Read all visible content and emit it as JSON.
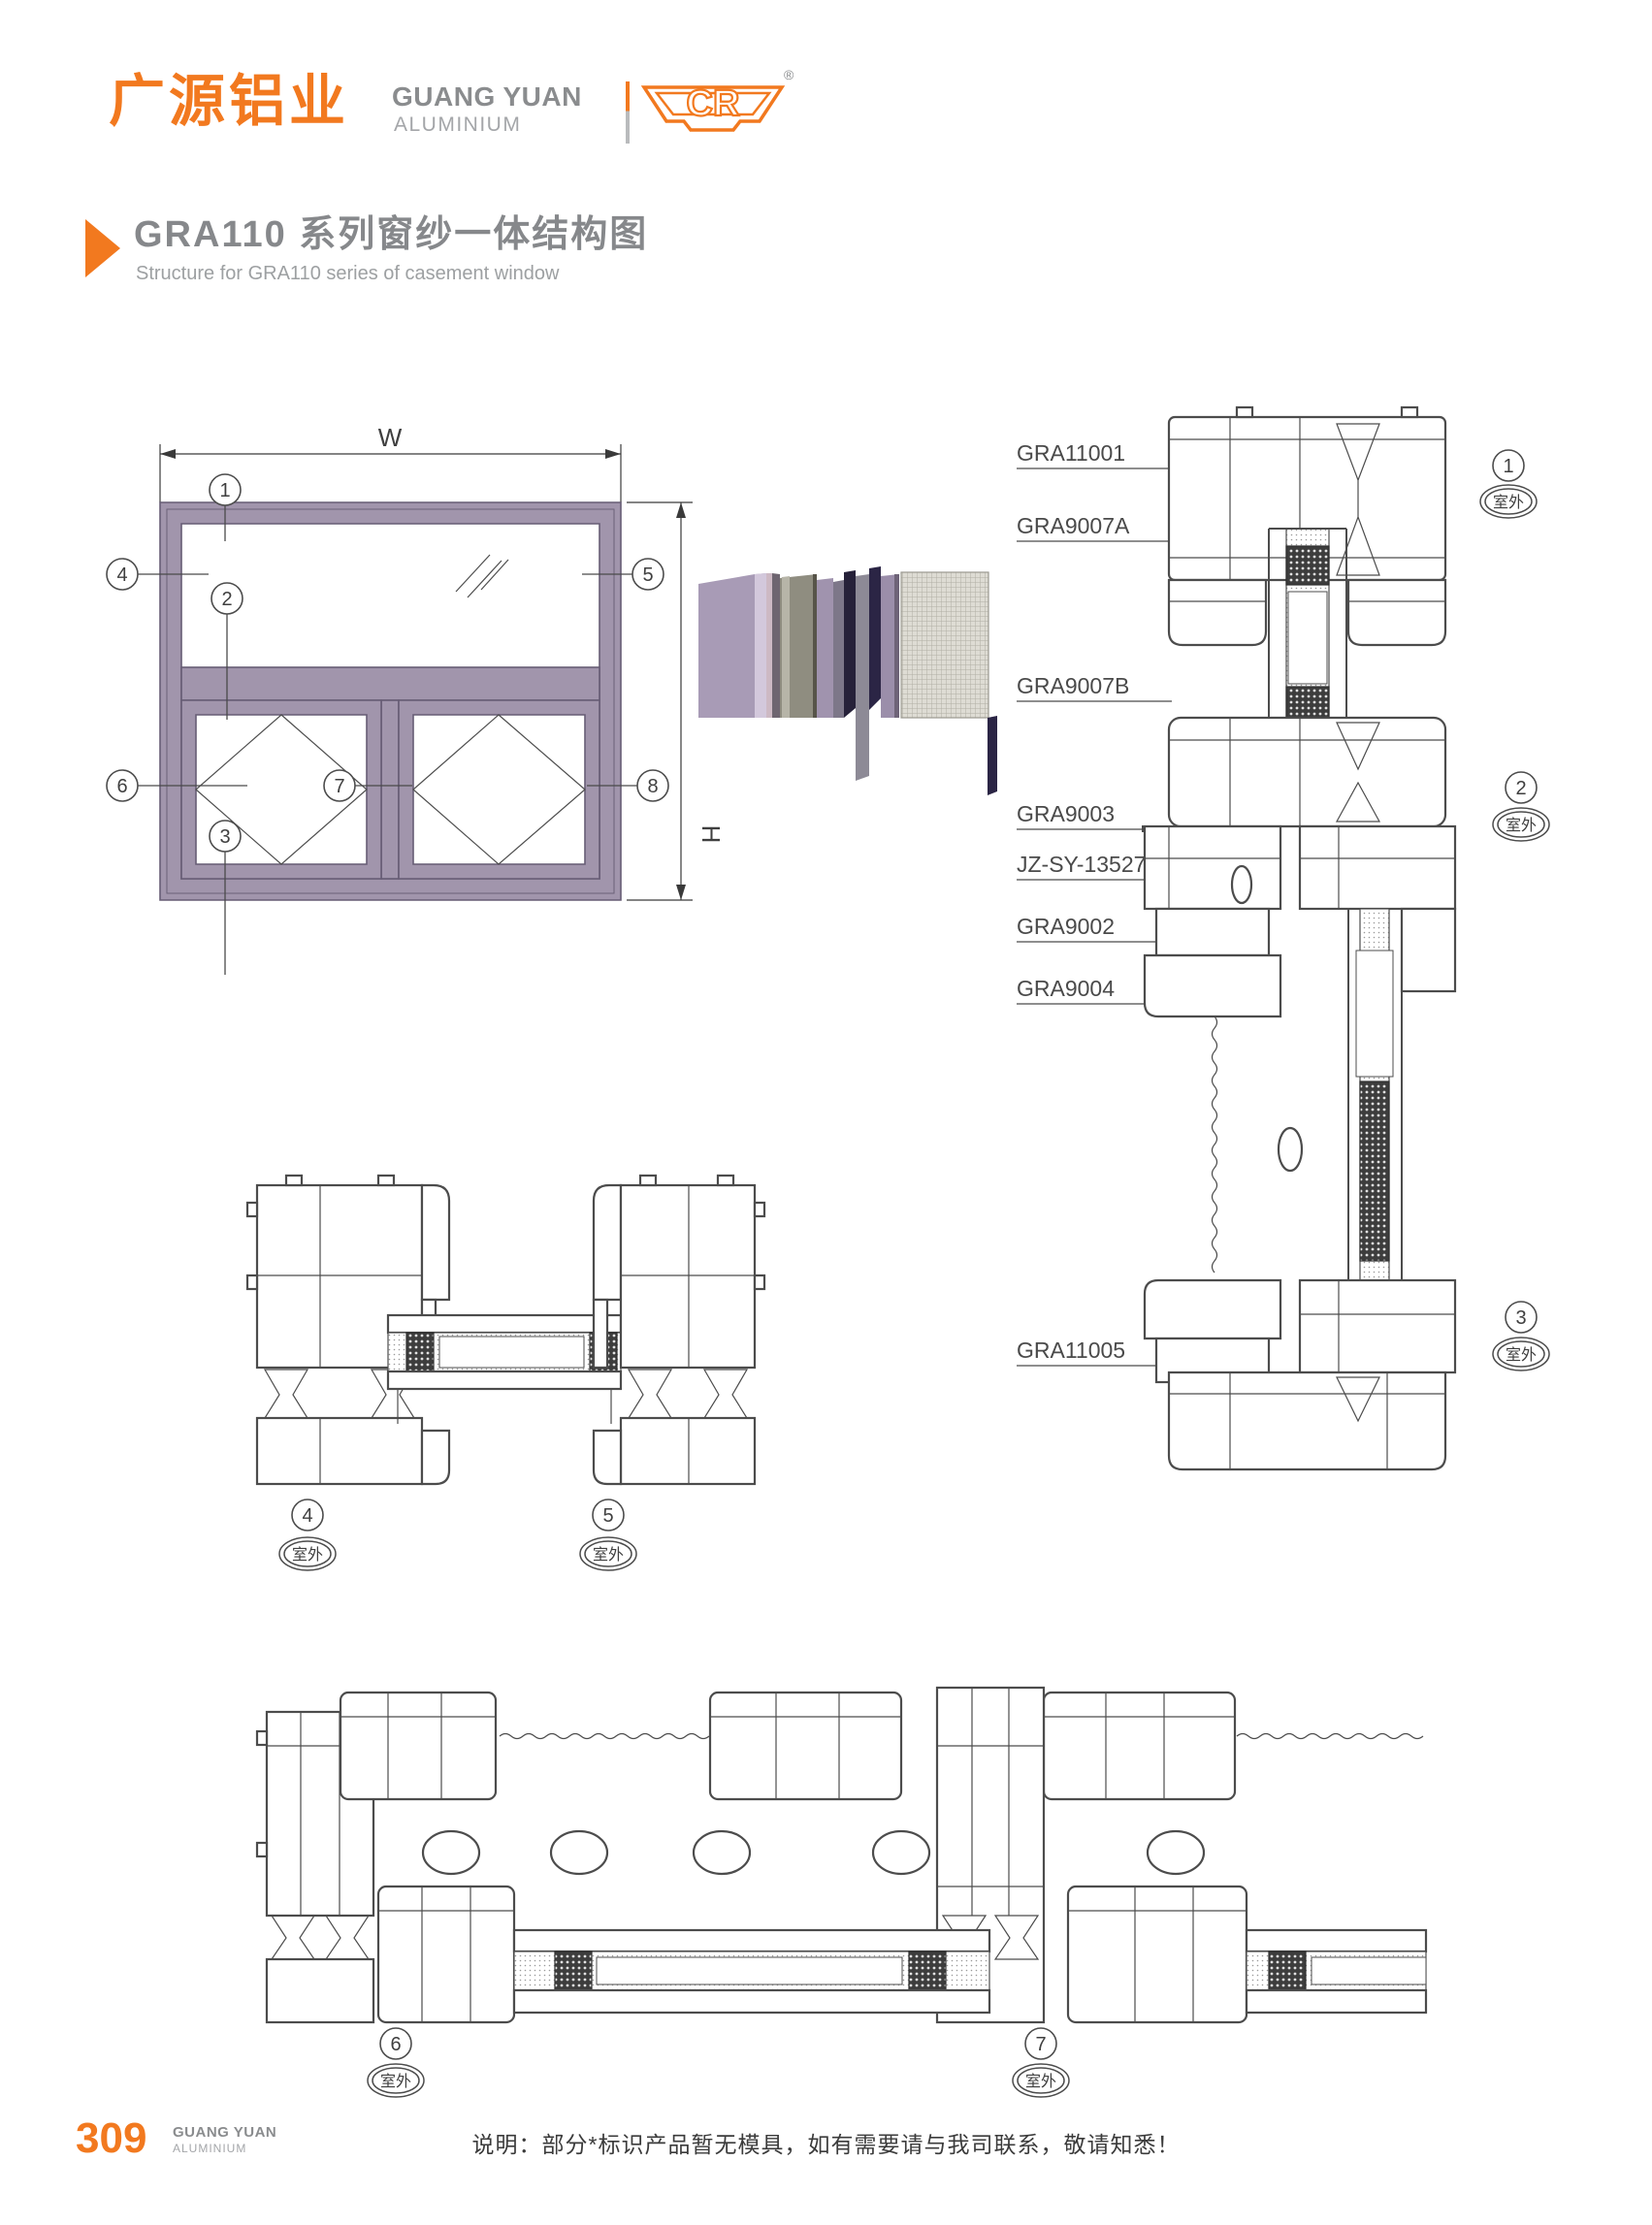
{
  "header": {
    "logo_cn": "广源铝业",
    "logo_en_line1": "GUANG YUAN",
    "logo_en_line2": "ALUMINIUM",
    "badge_letters": "CR",
    "badge_reg": "®"
  },
  "title": {
    "main": "GRA110 系列窗纱一体结构图",
    "sub": "Structure for GRA110 series of casement window"
  },
  "diagram": {
    "dim_width_label": "W",
    "dim_height_label": "H",
    "outdoor_label": "室外",
    "callouts": [
      "1",
      "2",
      "3",
      "4",
      "5",
      "6",
      "7",
      "8"
    ],
    "part_labels": [
      "GRA11001",
      "GRA9007A",
      "GRA9007B",
      "GRA9003",
      "JZ-SY-13527",
      "GRA9002",
      "GRA9004",
      "GRA11005"
    ]
  },
  "footer": {
    "page_number": "309",
    "brand_line1": "GUANG YUAN",
    "brand_line2": "ALUMINIUM",
    "note": "说明：部分*标识产品暂无模具，如有需要请与我司联系，敬请知悉！"
  },
  "colors": {
    "accent_orange": "#f2791f",
    "frame_mauve": "#a195ac",
    "drawing_line": "#4c4c4c",
    "heading_gray": "#86888b"
  }
}
